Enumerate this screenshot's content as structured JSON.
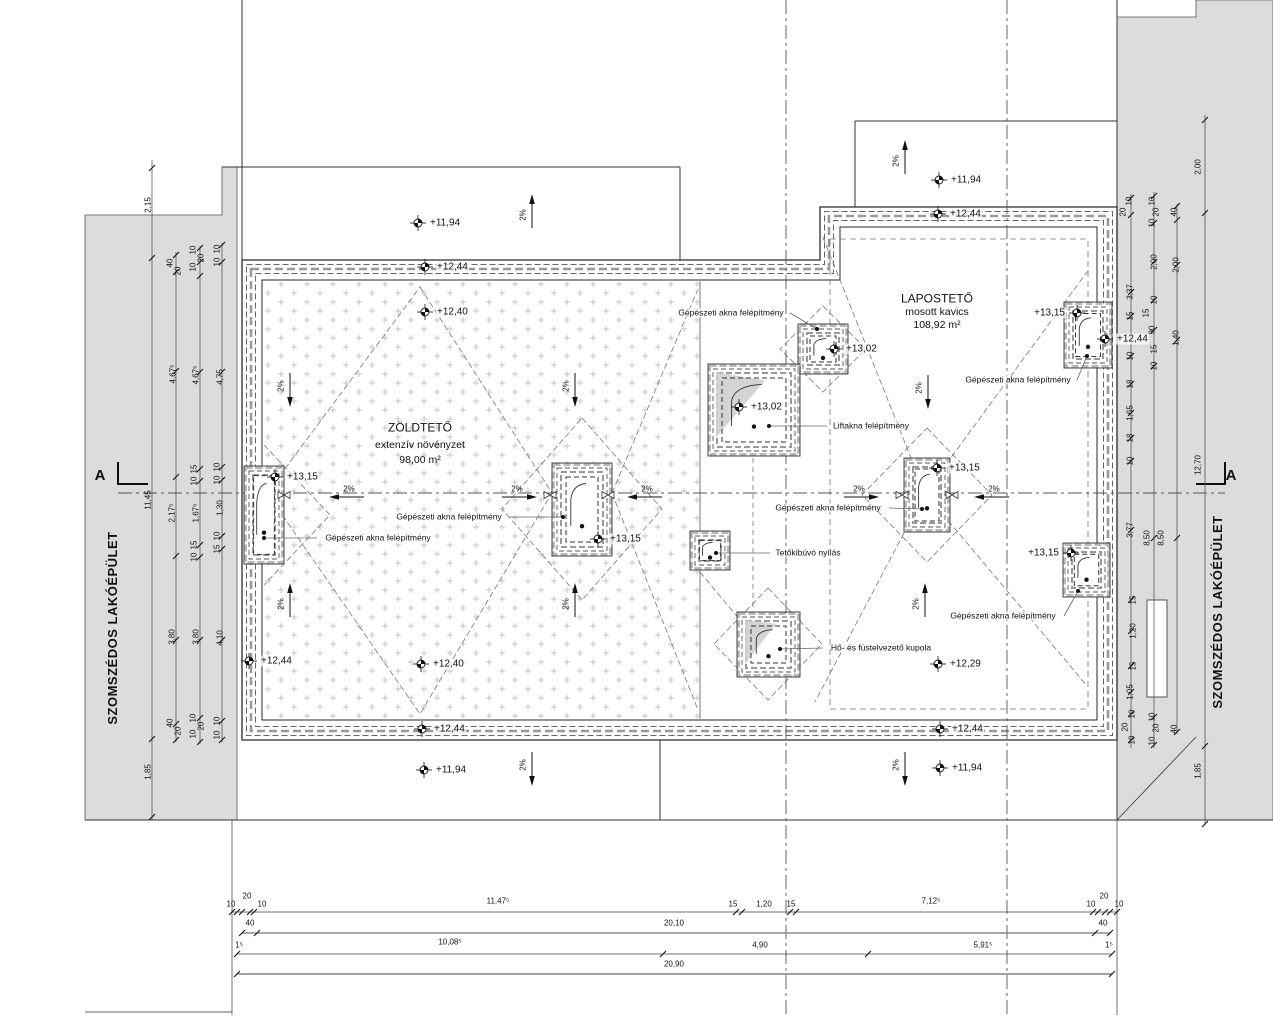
{
  "titles": {
    "left_building": "SZOMSZÉDOS LAKÓÉPÜLET",
    "right_building": "SZOMSZÉDOS LAKÓÉPÜLET",
    "section_left": "A",
    "section_right": "A"
  },
  "green_roof": {
    "title": "ZÖLDTETŐ",
    "subtitle": "extenzív növényzet",
    "area": "98,00 m²"
  },
  "flat_roof": {
    "title": "LAPOSTETŐ",
    "subtitle": "mosott kavics",
    "area": "108,92 m²"
  },
  "elevations": [
    {
      "x": 418,
      "y": 223,
      "label": "+11,94"
    },
    {
      "x": 425,
      "y": 267,
      "label": "+12,44"
    },
    {
      "x": 425,
      "y": 312,
      "label": "+12,40"
    },
    {
      "x": 939,
      "y": 180,
      "label": "+11,94"
    },
    {
      "x": 938,
      "y": 214,
      "label": "+12,44"
    },
    {
      "x": 275,
      "y": 477,
      "label": "+13,15"
    },
    {
      "x": 598,
      "y": 539,
      "label": "+13,15"
    },
    {
      "x": 834,
      "y": 349,
      "label": "+13,02"
    },
    {
      "x": 739,
      "y": 407,
      "label": "+13,02"
    },
    {
      "x": 937,
      "y": 468,
      "label": "+13,15"
    },
    {
      "x": 1077,
      "y": 313,
      "label": "+13,15",
      "side": "left"
    },
    {
      "x": 1105,
      "y": 339,
      "label": "+12,44"
    },
    {
      "x": 1071,
      "y": 553,
      "label": "+13,15",
      "side": "left"
    },
    {
      "x": 249,
      "y": 661,
      "label": "+12,44"
    },
    {
      "x": 421,
      "y": 664,
      "label": "+12,40"
    },
    {
      "x": 422,
      "y": 729,
      "label": "+12,44"
    },
    {
      "x": 424,
      "y": 770,
      "label": "+11,94"
    },
    {
      "x": 938,
      "y": 664,
      "label": "+12,29"
    },
    {
      "x": 940,
      "y": 729,
      "label": "+12,44"
    },
    {
      "x": 940,
      "y": 768,
      "label": "+11,94"
    }
  ],
  "slopes": [
    {
      "x": 532,
      "y": 212,
      "dir": "up",
      "label": "2%"
    },
    {
      "x": 905,
      "y": 158,
      "dir": "up",
      "label": "2%"
    },
    {
      "x": 290,
      "y": 389,
      "dir": "down",
      "label": "2%"
    },
    {
      "x": 575,
      "y": 389,
      "dir": "down",
      "label": "2%"
    },
    {
      "x": 928,
      "y": 391,
      "dir": "down",
      "label": "2%"
    },
    {
      "x": 290,
      "y": 601,
      "dir": "up",
      "label": "2%"
    },
    {
      "x": 575,
      "y": 601,
      "dir": "up",
      "label": "2%"
    },
    {
      "x": 925,
      "y": 601,
      "dir": "up",
      "label": "2%"
    },
    {
      "x": 532,
      "y": 768,
      "dir": "down",
      "label": "2%"
    },
    {
      "x": 905,
      "y": 768,
      "dir": "down",
      "label": "2%"
    },
    {
      "x": 347,
      "y": 497,
      "dir": "left",
      "label": "2%"
    },
    {
      "x": 519,
      "y": 497,
      "dir": "right",
      "label": "2%"
    },
    {
      "x": 645,
      "y": 497,
      "dir": "left",
      "label": "2%"
    },
    {
      "x": 861,
      "y": 497,
      "dir": "right",
      "label": "2%"
    },
    {
      "x": 992,
      "y": 497,
      "dir": "left",
      "label": "2%"
    }
  ],
  "leaders": [
    {
      "text": "Gépészeti akna felépítmény",
      "cx": 731,
      "cy": 313,
      "line": [
        790,
        313,
        817,
        329
      ]
    },
    {
      "text": "Liftakna felépítmény",
      "cx": 871,
      "cy": 426,
      "line": [
        827,
        426,
        769,
        426
      ]
    },
    {
      "text": "Gépészeti akna felépítmény",
      "cx": 1018,
      "cy": 380,
      "line": [
        1077,
        380,
        1087,
        356
      ]
    },
    {
      "text": "Gépészeti akna felépítmény",
      "cx": 449,
      "cy": 517,
      "line": [
        509,
        517,
        563,
        517
      ]
    },
    {
      "text": "Gépészeti akna felépítmény",
      "cx": 378,
      "cy": 538,
      "line": [
        317,
        538,
        264,
        538
      ]
    },
    {
      "text": "Gépészeti akna felépítmény",
      "cx": 828,
      "cy": 508,
      "line": [
        889,
        508,
        922,
        509
      ]
    },
    {
      "text": "Tetőkibúvó nyílás",
      "cx": 808,
      "cy": 553,
      "line": [
        770,
        553,
        716,
        553
      ]
    },
    {
      "text": "Gépészeti akna felépítmény",
      "cx": 1003,
      "cy": 616,
      "line": [
        1064,
        616,
        1078,
        591
      ]
    },
    {
      "text": "Hő- és füstelvezető kupola",
      "cx": 881,
      "cy": 648,
      "line": [
        823,
        648,
        780,
        649
      ]
    }
  ],
  "shafts": [
    {
      "x": 244,
      "y": 466,
      "w": 40,
      "h": 98
    },
    {
      "x": 552,
      "y": 463,
      "w": 60,
      "h": 93
    },
    {
      "x": 798,
      "y": 324,
      "w": 50,
      "h": 50
    },
    {
      "x": 708,
      "y": 364,
      "w": 92,
      "h": 92,
      "tri": true
    },
    {
      "x": 904,
      "y": 458,
      "w": 46,
      "h": 74
    },
    {
      "x": 1064,
      "y": 302,
      "w": 48,
      "h": 66
    },
    {
      "x": 1063,
      "y": 543,
      "w": 47,
      "h": 54
    },
    {
      "x": 690,
      "y": 531,
      "w": 40,
      "h": 39
    },
    {
      "x": 737,
      "y": 612,
      "w": 63,
      "h": 65,
      "tri": true
    }
  ],
  "drains": [
    [
      284,
      495
    ],
    [
      550,
      495
    ],
    [
      608,
      495
    ],
    [
      902,
      495
    ],
    [
      952,
      495
    ]
  ],
  "dims_bottom": [
    {
      "t": "10",
      "x": 231,
      "y": 905
    },
    {
      "t": "20",
      "x": 247,
      "y": 897
    },
    {
      "t": "10",
      "x": 262,
      "y": 905
    },
    {
      "t": "11,47⁵",
      "x": 498,
      "y": 902
    },
    {
      "t": "15",
      "x": 733,
      "y": 905
    },
    {
      "t": "1,20",
      "x": 764,
      "y": 905
    },
    {
      "t": "15",
      "x": 791,
      "y": 905
    },
    {
      "t": "7,12⁵",
      "x": 931,
      "y": 902
    },
    {
      "t": "10",
      "x": 1091,
      "y": 905
    },
    {
      "t": "20",
      "x": 1104,
      "y": 897
    },
    {
      "t": "10",
      "x": 1119,
      "y": 905
    },
    {
      "t": "40",
      "x": 250,
      "y": 924
    },
    {
      "t": "20,10",
      "x": 674,
      "y": 924
    },
    {
      "t": "40",
      "x": 1103,
      "y": 924
    },
    {
      "t": "1⁵",
      "x": 239,
      "y": 946
    },
    {
      "t": "10,08⁵",
      "x": 450,
      "y": 943
    },
    {
      "t": "4,90",
      "x": 760,
      "y": 946
    },
    {
      "t": "5,91⁵",
      "x": 983,
      "y": 946
    },
    {
      "t": "1⁵",
      "x": 1109,
      "y": 946
    },
    {
      "t": "20,90",
      "x": 674,
      "y": 965
    }
  ],
  "dims_left": [
    {
      "t": "2,15",
      "x": 149,
      "y": 205
    },
    {
      "t": "11,45",
      "x": 149,
      "y": 500
    },
    {
      "t": "1,85",
      "x": 149,
      "y": 772
    },
    {
      "t": "40",
      "x": 171,
      "y": 263
    },
    {
      "t": "20",
      "x": 179,
      "y": 271
    },
    {
      "t": "4,67⁵",
      "x": 174,
      "y": 374
    },
    {
      "t": "2,17⁵",
      "x": 173,
      "y": 513
    },
    {
      "t": "3,80",
      "x": 173,
      "y": 637
    },
    {
      "t": "40",
      "x": 171,
      "y": 723
    },
    {
      "t": "20",
      "x": 179,
      "y": 731
    },
    {
      "t": "10",
      "x": 194,
      "y": 250
    },
    {
      "t": "20",
      "x": 202,
      "y": 258
    },
    {
      "t": "10",
      "x": 194,
      "y": 267
    },
    {
      "t": "4,67⁵",
      "x": 197,
      "y": 375
    },
    {
      "t": "15",
      "x": 195,
      "y": 469
    },
    {
      "t": "10",
      "x": 195,
      "y": 481
    },
    {
      "t": "1,67⁵",
      "x": 197,
      "y": 513
    },
    {
      "t": "15",
      "x": 195,
      "y": 545
    },
    {
      "t": "10",
      "x": 195,
      "y": 557
    },
    {
      "t": "3,80",
      "x": 197,
      "y": 637
    },
    {
      "t": "10",
      "x": 194,
      "y": 718
    },
    {
      "t": "20",
      "x": 202,
      "y": 726
    },
    {
      "t": "10",
      "x": 194,
      "y": 734
    },
    {
      "t": "10",
      "x": 218,
      "y": 249
    },
    {
      "t": "10",
      "x": 218,
      "y": 262
    },
    {
      "t": "4,75",
      "x": 221,
      "y": 377
    },
    {
      "t": "10",
      "x": 218,
      "y": 467
    },
    {
      "t": "10",
      "x": 218,
      "y": 480
    },
    {
      "t": "1,30",
      "x": 221,
      "y": 508
    },
    {
      "t": "10",
      "x": 218,
      "y": 536
    },
    {
      "t": "15",
      "x": 218,
      "y": 549
    },
    {
      "t": "4,10",
      "x": 221,
      "y": 638
    },
    {
      "t": "10",
      "x": 218,
      "y": 721
    },
    {
      "t": "10",
      "x": 218,
      "y": 735
    }
  ],
  "dims_right": [
    {
      "t": "10",
      "x": 1130,
      "y": 201
    },
    {
      "t": "20",
      "x": 1124,
      "y": 212
    },
    {
      "t": "3,37",
      "x": 1131,
      "y": 292
    },
    {
      "t": "15",
      "x": 1131,
      "y": 316
    },
    {
      "t": "10",
      "x": 1131,
      "y": 356
    },
    {
      "t": "18",
      "x": 1131,
      "y": 384
    },
    {
      "t": "1,65",
      "x": 1131,
      "y": 413
    },
    {
      "t": "18",
      "x": 1131,
      "y": 438
    },
    {
      "t": "10",
      "x": 1131,
      "y": 461
    },
    {
      "t": "3,77",
      "x": 1131,
      "y": 530
    },
    {
      "t": "15",
      "x": 1134,
      "y": 600
    },
    {
      "t": "1,20",
      "x": 1134,
      "y": 631
    },
    {
      "t": "15",
      "x": 1134,
      "y": 666
    },
    {
      "t": "1,05",
      "x": 1131,
      "y": 692
    },
    {
      "t": "10",
      "x": 1133,
      "y": 714
    },
    {
      "t": "20",
      "x": 1126,
      "y": 727
    },
    {
      "t": "10",
      "x": 1133,
      "y": 740
    },
    {
      "t": "10",
      "x": 1153,
      "y": 201
    },
    {
      "t": "20",
      "x": 1157,
      "y": 212
    },
    {
      "t": "10",
      "x": 1153,
      "y": 223
    },
    {
      "t": "2,00",
      "x": 1155,
      "y": 262
    },
    {
      "t": "10",
      "x": 1155,
      "y": 300
    },
    {
      "t": "15",
      "x": 1147,
      "y": 313
    },
    {
      "t": "90",
      "x": 1153,
      "y": 330
    },
    {
      "t": "15",
      "x": 1155,
      "y": 349
    },
    {
      "t": "10",
      "x": 1155,
      "y": 366
    },
    {
      "t": "8,50",
      "x": 1148,
      "y": 538
    },
    {
      "t": "8,50",
      "x": 1162,
      "y": 538
    },
    {
      "t": "10",
      "x": 1153,
      "y": 717
    },
    {
      "t": "20",
      "x": 1157,
      "y": 728
    },
    {
      "t": "10",
      "x": 1153,
      "y": 741
    },
    {
      "t": "40",
      "x": 1175,
      "y": 212
    },
    {
      "t": "2,00",
      "x": 1177,
      "y": 265
    },
    {
      "t": "1,40",
      "x": 1177,
      "y": 338
    },
    {
      "t": "40",
      "x": 1175,
      "y": 729
    },
    {
      "t": "2,00",
      "x": 1199,
      "y": 167
    },
    {
      "t": "12,70",
      "x": 1199,
      "y": 465
    },
    {
      "t": "1,85",
      "x": 1199,
      "y": 771
    }
  ]
}
